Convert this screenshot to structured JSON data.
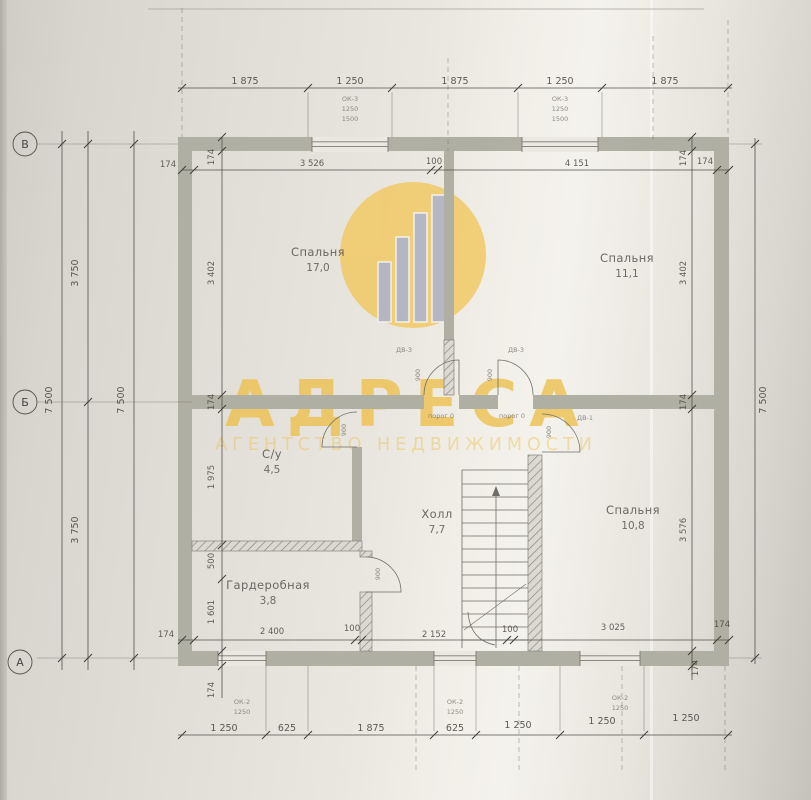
{
  "sheet": {
    "axis_labels": [
      "В",
      "Б",
      "А"
    ]
  },
  "dimensions": {
    "top_row": [
      "1 875",
      "1 250",
      "1 875",
      "1 250",
      "1 875"
    ],
    "top_inner": [
      "174",
      "3 526",
      "100",
      "4 151",
      "174"
    ],
    "bottom_inner": [
      "174",
      "2 400",
      "100",
      "2 152",
      "100",
      "3 025",
      "174"
    ],
    "bottom_row": [
      "1 250",
      "625",
      "1 875",
      "625",
      "1 250",
      "1 250",
      "1 250"
    ],
    "left_total_outer": "7 500",
    "left_halves": [
      "3 750",
      "3 750"
    ],
    "left_total_inner": "7 500",
    "right_total": "7 500",
    "left_interior": [
      "174",
      "3 402",
      "174",
      "1 975",
      "500",
      "1 601",
      "174"
    ],
    "right_interior": [
      "174",
      "3 402",
      "174",
      "3 576",
      "174"
    ]
  },
  "rooms": [
    {
      "name": "Спальня",
      "area": "17,0"
    },
    {
      "name": "Спальня",
      "area": "11,1"
    },
    {
      "name": "С/у",
      "area": "4,5"
    },
    {
      "name": "Холл",
      "area": "7,7"
    },
    {
      "name": "Спальня",
      "area": "10,8"
    },
    {
      "name": "Гардеробная",
      "area": "3,8"
    }
  ],
  "doors": {
    "tag_left": "ДВ-3",
    "tag_right": "ДВ-3",
    "tag_bedroom": "ДВ-1",
    "width": "900",
    "threshold": "порог 0"
  },
  "windows": {
    "tag_top": "ОК-3",
    "tag_bottom": "ОК-2",
    "width": "1250",
    "height": "1500"
  },
  "watermark": {
    "title": "АДРЕСА",
    "subtitle": "АГЕНТСТВО НЕДВИЖИМОСТИ",
    "accent_color": "#edc14f"
  }
}
